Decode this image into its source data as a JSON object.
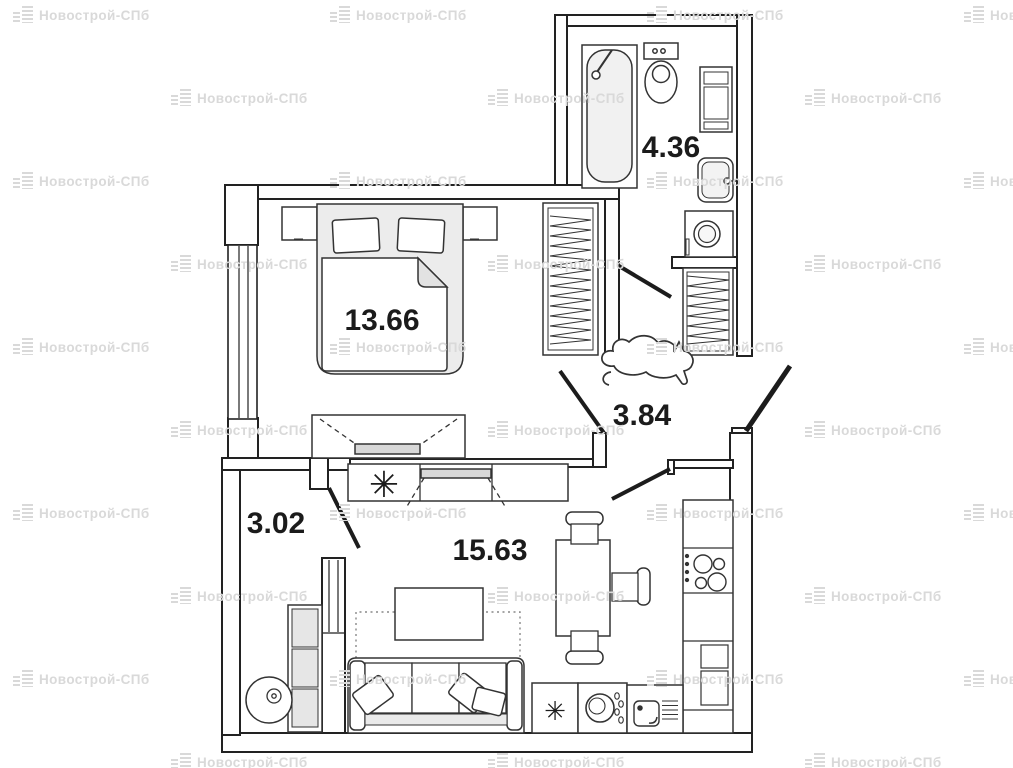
{
  "watermark": {
    "text": "Новострой-СПб",
    "color": "#d9d9d9"
  },
  "plan": {
    "rooms": {
      "bedroom": {
        "area": "13.66"
      },
      "bathroom": {
        "area": "4.36"
      },
      "hallway": {
        "area": "3.84"
      },
      "entry_hall": {
        "area": "3.02"
      },
      "living_kitchen": {
        "area": "15.63"
      }
    },
    "symbols": {
      "plant": "✳",
      "freezer": "✳"
    },
    "line_color": "#222222",
    "label_color": "#1b1b1b"
  }
}
